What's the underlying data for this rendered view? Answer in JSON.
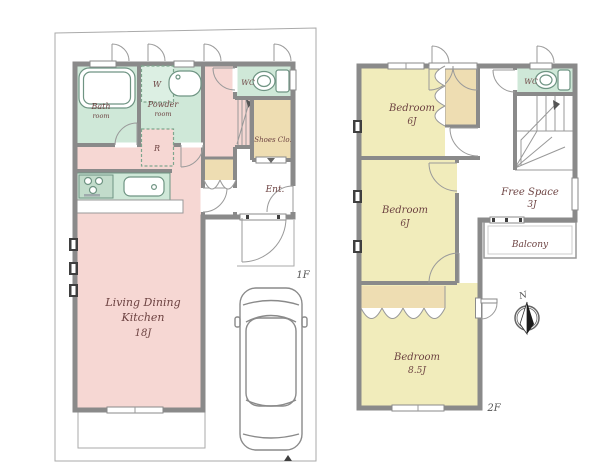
{
  "colors": {
    "ldk_pink": "#f6d7d3",
    "bedroom_yellow": "#f1ecbb",
    "bath_mint": "#cfe8d8",
    "closet_tan": "#eeddb2",
    "washer_mint": "#dcefe3",
    "wall_gray": "#8a8a8a",
    "label_brown": "#6d4342",
    "floor_label_gray": "#555555"
  },
  "floor1": {
    "floor_label": "1F",
    "ldk_line1": "Living Dining",
    "ldk_line2": "Kitchen",
    "ldk_size": "18J",
    "bath_line1": "Bath",
    "bath_line2": "room",
    "powder_line1": "Powder",
    "powder_line2": "room",
    "wc": "WC",
    "washer": "W",
    "fridge": "R",
    "shoes_closet": "Shoes Clo.",
    "entrance": "Ent."
  },
  "floor2": {
    "floor_label": "2F",
    "bedroom1_name": "Bedroom",
    "bedroom1_size": "6J",
    "bedroom2_name": "Bedroom",
    "bedroom2_size": "6J",
    "bedroom3_name": "Bedroom",
    "bedroom3_size": "8.5J",
    "free_space_name": "Free Space",
    "free_space_size": "3J",
    "balcony": "Balcony",
    "wc": "WC"
  },
  "compass_north": "N"
}
